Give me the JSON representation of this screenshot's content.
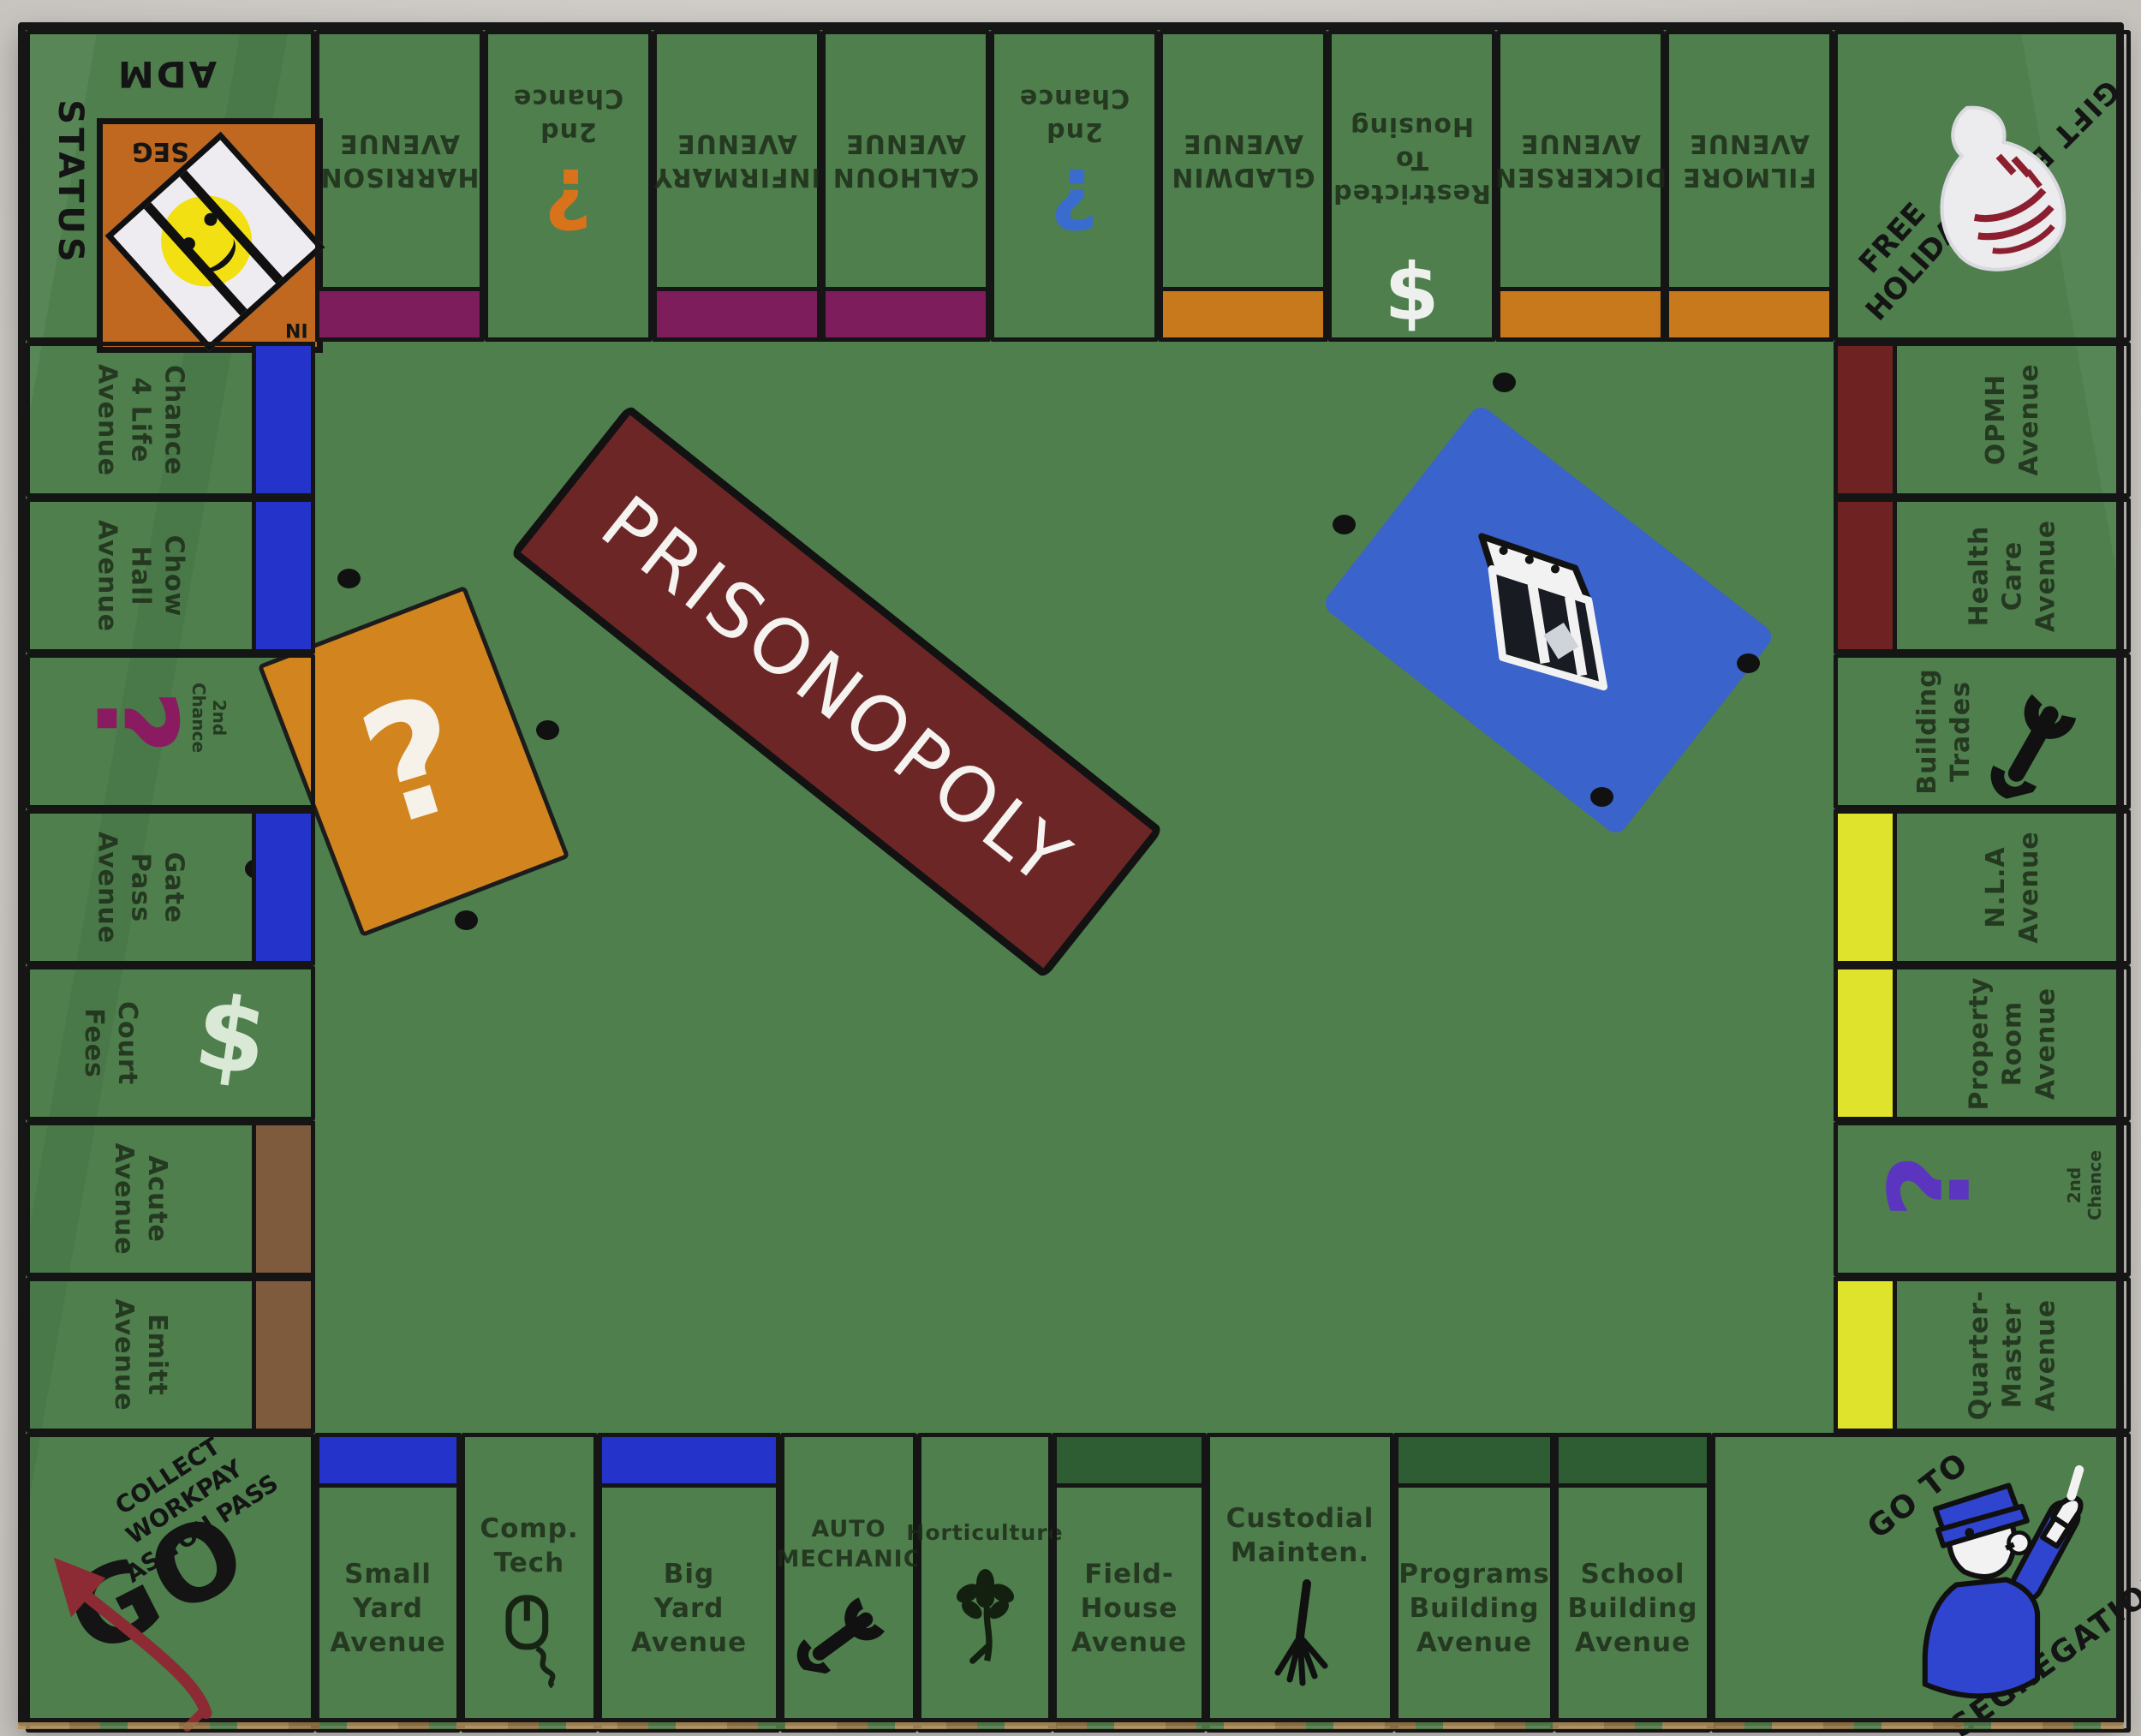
{
  "title": "PRISONOPOLY",
  "palette": {
    "photo_background": "#cfccc7",
    "board_green": "#4e7f4d",
    "line_black": "#161616",
    "bar_purple": "#7d1d5c",
    "bar_orange": "#c8791c",
    "bar_blue": "#2433c9",
    "bar_brown": "#7d5b3c",
    "bar_darkred": "#6e2222",
    "bar_yellow": "#dfe32b",
    "bar_darkgreen": "#2e5c33",
    "banner_red": "#6d2626",
    "card_orange": "#d2851f",
    "card_blue": "#3a63cb",
    "corner_square_orange": "#c06820",
    "arrow_red": "#8c2b33",
    "cop_blue": "#2f45cf",
    "question_orange": "#d8731c",
    "question_blue": "#3a6cd0",
    "question_magenta": "#8a1b60",
    "question_purple": "#5b35c0"
  },
  "corners": {
    "top_left": {
      "adm": "ADM",
      "status": "STATUS",
      "seg": "SEG",
      "in_label": "IN"
    },
    "top_right": {
      "free_holiday": "FREE\nHOLIDAY",
      "gift_bag": "GIFT BAG"
    },
    "bottom_left": {
      "collect": "COLLECT\nWORKPAY\nAS YOU PASS",
      "go": "GO"
    },
    "bottom_right": {
      "go_to": "GO TO",
      "segregation": "SEGREGATION"
    }
  },
  "top_row": [
    {
      "label": "HARRISON\nAVENUE",
      "bar": "purple"
    },
    {
      "label": "2nd\nChance",
      "icon": "question-mark",
      "icon_char": "?"
    },
    {
      "label": "INFIRMARY\nAVENUE",
      "bar": "purple"
    },
    {
      "label": "CALHOUN\nAVENUE",
      "bar": "purple"
    },
    {
      "label": "2nd\nChance",
      "icon": "question-mark",
      "icon_char": "?"
    },
    {
      "label": "GLADWIN\nAVENUE",
      "bar": "orange"
    },
    {
      "label": "Restricted\nTo\nHousing",
      "icon": "dollar-sign",
      "icon_char": "$"
    },
    {
      "label": "DICKERSEN\nAVENUE",
      "bar": "orange"
    },
    {
      "label": "FILMORE\nAVENUE",
      "bar": "orange"
    }
  ],
  "left_col": [
    {
      "label": "Chance\n4 Life\nAvenue",
      "bar": "blue"
    },
    {
      "label": "Chow\nHall\nAvenue",
      "bar": "blue"
    },
    {
      "label": "2nd\nChance",
      "icon": "question-mark",
      "icon_char": "?"
    },
    {
      "label": "Gate\nPass\nAvenue",
      "bar": "blue"
    },
    {
      "label": "Court\nFees",
      "icon": "dollar-sign",
      "icon_char": "$"
    },
    {
      "label": "Acute\nAvenue",
      "bar": "brown"
    },
    {
      "label": "Emitt\nAvenue",
      "bar": "brown"
    }
  ],
  "right_col": [
    {
      "label": "OPMH\nAvenue",
      "bar": "darkred"
    },
    {
      "label": "Health\nCare\nAvenue",
      "bar": "darkred"
    },
    {
      "label": "Building\nTrades",
      "icon": "wrench"
    },
    {
      "label": "N.L.A\nAvenue",
      "bar": "yellow"
    },
    {
      "label": "Property\nRoom\nAvenue",
      "bar": "yellow"
    },
    {
      "label": "2nd\nChance",
      "icon": "question-mark",
      "icon_char": "?"
    },
    {
      "label": "Quarter-\nMaster\nAvenue",
      "bar": "yellow"
    }
  ],
  "bottom_row": [
    {
      "label": "Small\nYard\nAvenue",
      "bar": "blue"
    },
    {
      "label": "Comp.\nTech",
      "icon": "computer-mouse"
    },
    {
      "label": "Big\nYard\nAvenue",
      "bar": "blue"
    },
    {
      "label": "AUTO\nMECHANIC",
      "icon": "wrench"
    },
    {
      "label": "Horticulture",
      "icon": "flower"
    },
    {
      "label": "Field-\nHouse\nAvenue",
      "bar": "darkgreen"
    },
    {
      "label": "Custodial\nMainten.",
      "icon": "rake"
    },
    {
      "label": "Programs\nBuilding\nAvenue",
      "bar": "darkgreen"
    },
    {
      "label": "School\nBuilding\nAvenue",
      "bar": "darkgreen"
    }
  ],
  "center": {
    "banner_text": "PRISONOPOLY",
    "chance_question_mark": "?"
  }
}
